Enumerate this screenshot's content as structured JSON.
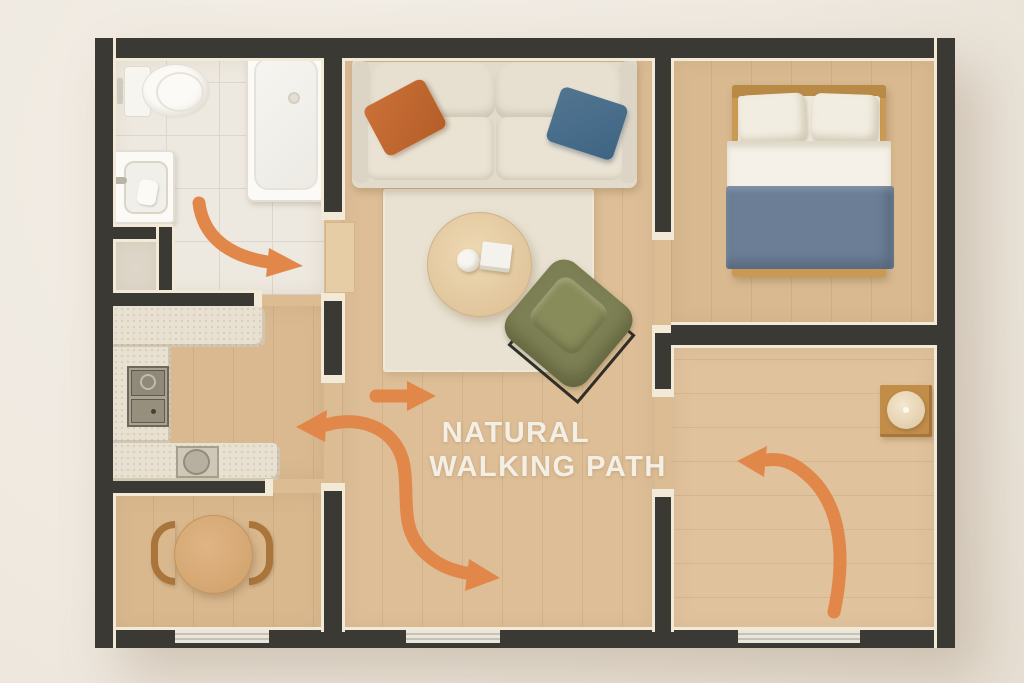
{
  "title": {
    "line1": "NATURAL",
    "line2": "WALKING PATH"
  },
  "diagram": {
    "type": "apartment-floor-plan-top-view",
    "annotation": "orange arrows showing the natural walking path through the apartment",
    "rooms": [
      {
        "name": "bathroom",
        "furniture": [
          "toilet",
          "wash-basin",
          "bathtub"
        ],
        "floor": "white tile"
      },
      {
        "name": "kitchen",
        "furniture": [
          "u-shaped-counter",
          "cooktop",
          "kitchen-sink"
        ],
        "floor": "light wood"
      },
      {
        "name": "dining-area",
        "furniture": [
          "round-dining-table",
          "chair-left",
          "chair-right"
        ],
        "floor": "light wood"
      },
      {
        "name": "living-room",
        "furniture": [
          "sofa",
          "orange-pillow",
          "blue-pillow",
          "rug",
          "round-coffee-table",
          "cup",
          "book",
          "green-armchair"
        ],
        "floor": "light wood"
      },
      {
        "name": "bedroom",
        "furniture": [
          "double-bed",
          "two-pillows",
          "blue-duvet"
        ],
        "floor": "light wood"
      },
      {
        "name": "second-room",
        "furniture": [
          "side-table",
          "lamp"
        ],
        "floor": "light wood"
      }
    ],
    "arrows": [
      {
        "id": "bathroom-exit",
        "shape": "curved",
        "direction": "right"
      },
      {
        "id": "hallway-straight",
        "shape": "straight",
        "direction": "right"
      },
      {
        "id": "living-s-curve",
        "shape": "s-curve",
        "direction": "double-headed left and down-right"
      },
      {
        "id": "second-room-curve",
        "shape": "curved",
        "direction": "up-left"
      }
    ],
    "windows": 3
  },
  "colors": {
    "accent_orange": "#e2874a",
    "wall": "#3a3934",
    "wall_face": "#f2e9d6",
    "floor_wood": "#dcbc92",
    "tile": "#eee9e0",
    "sofa_beige": "#e2dbcc",
    "pillow_orange": "#c06a33",
    "pillow_blue": "#4b6f8c",
    "duvet_blue": "#6b7e96",
    "armchair_green": "#7d8054",
    "rug": "#e9e2d2",
    "counter": "#e8e1d1",
    "table_wood": "#d5a976",
    "text_color": "#f4efe5",
    "background": "#f0ebe2"
  }
}
